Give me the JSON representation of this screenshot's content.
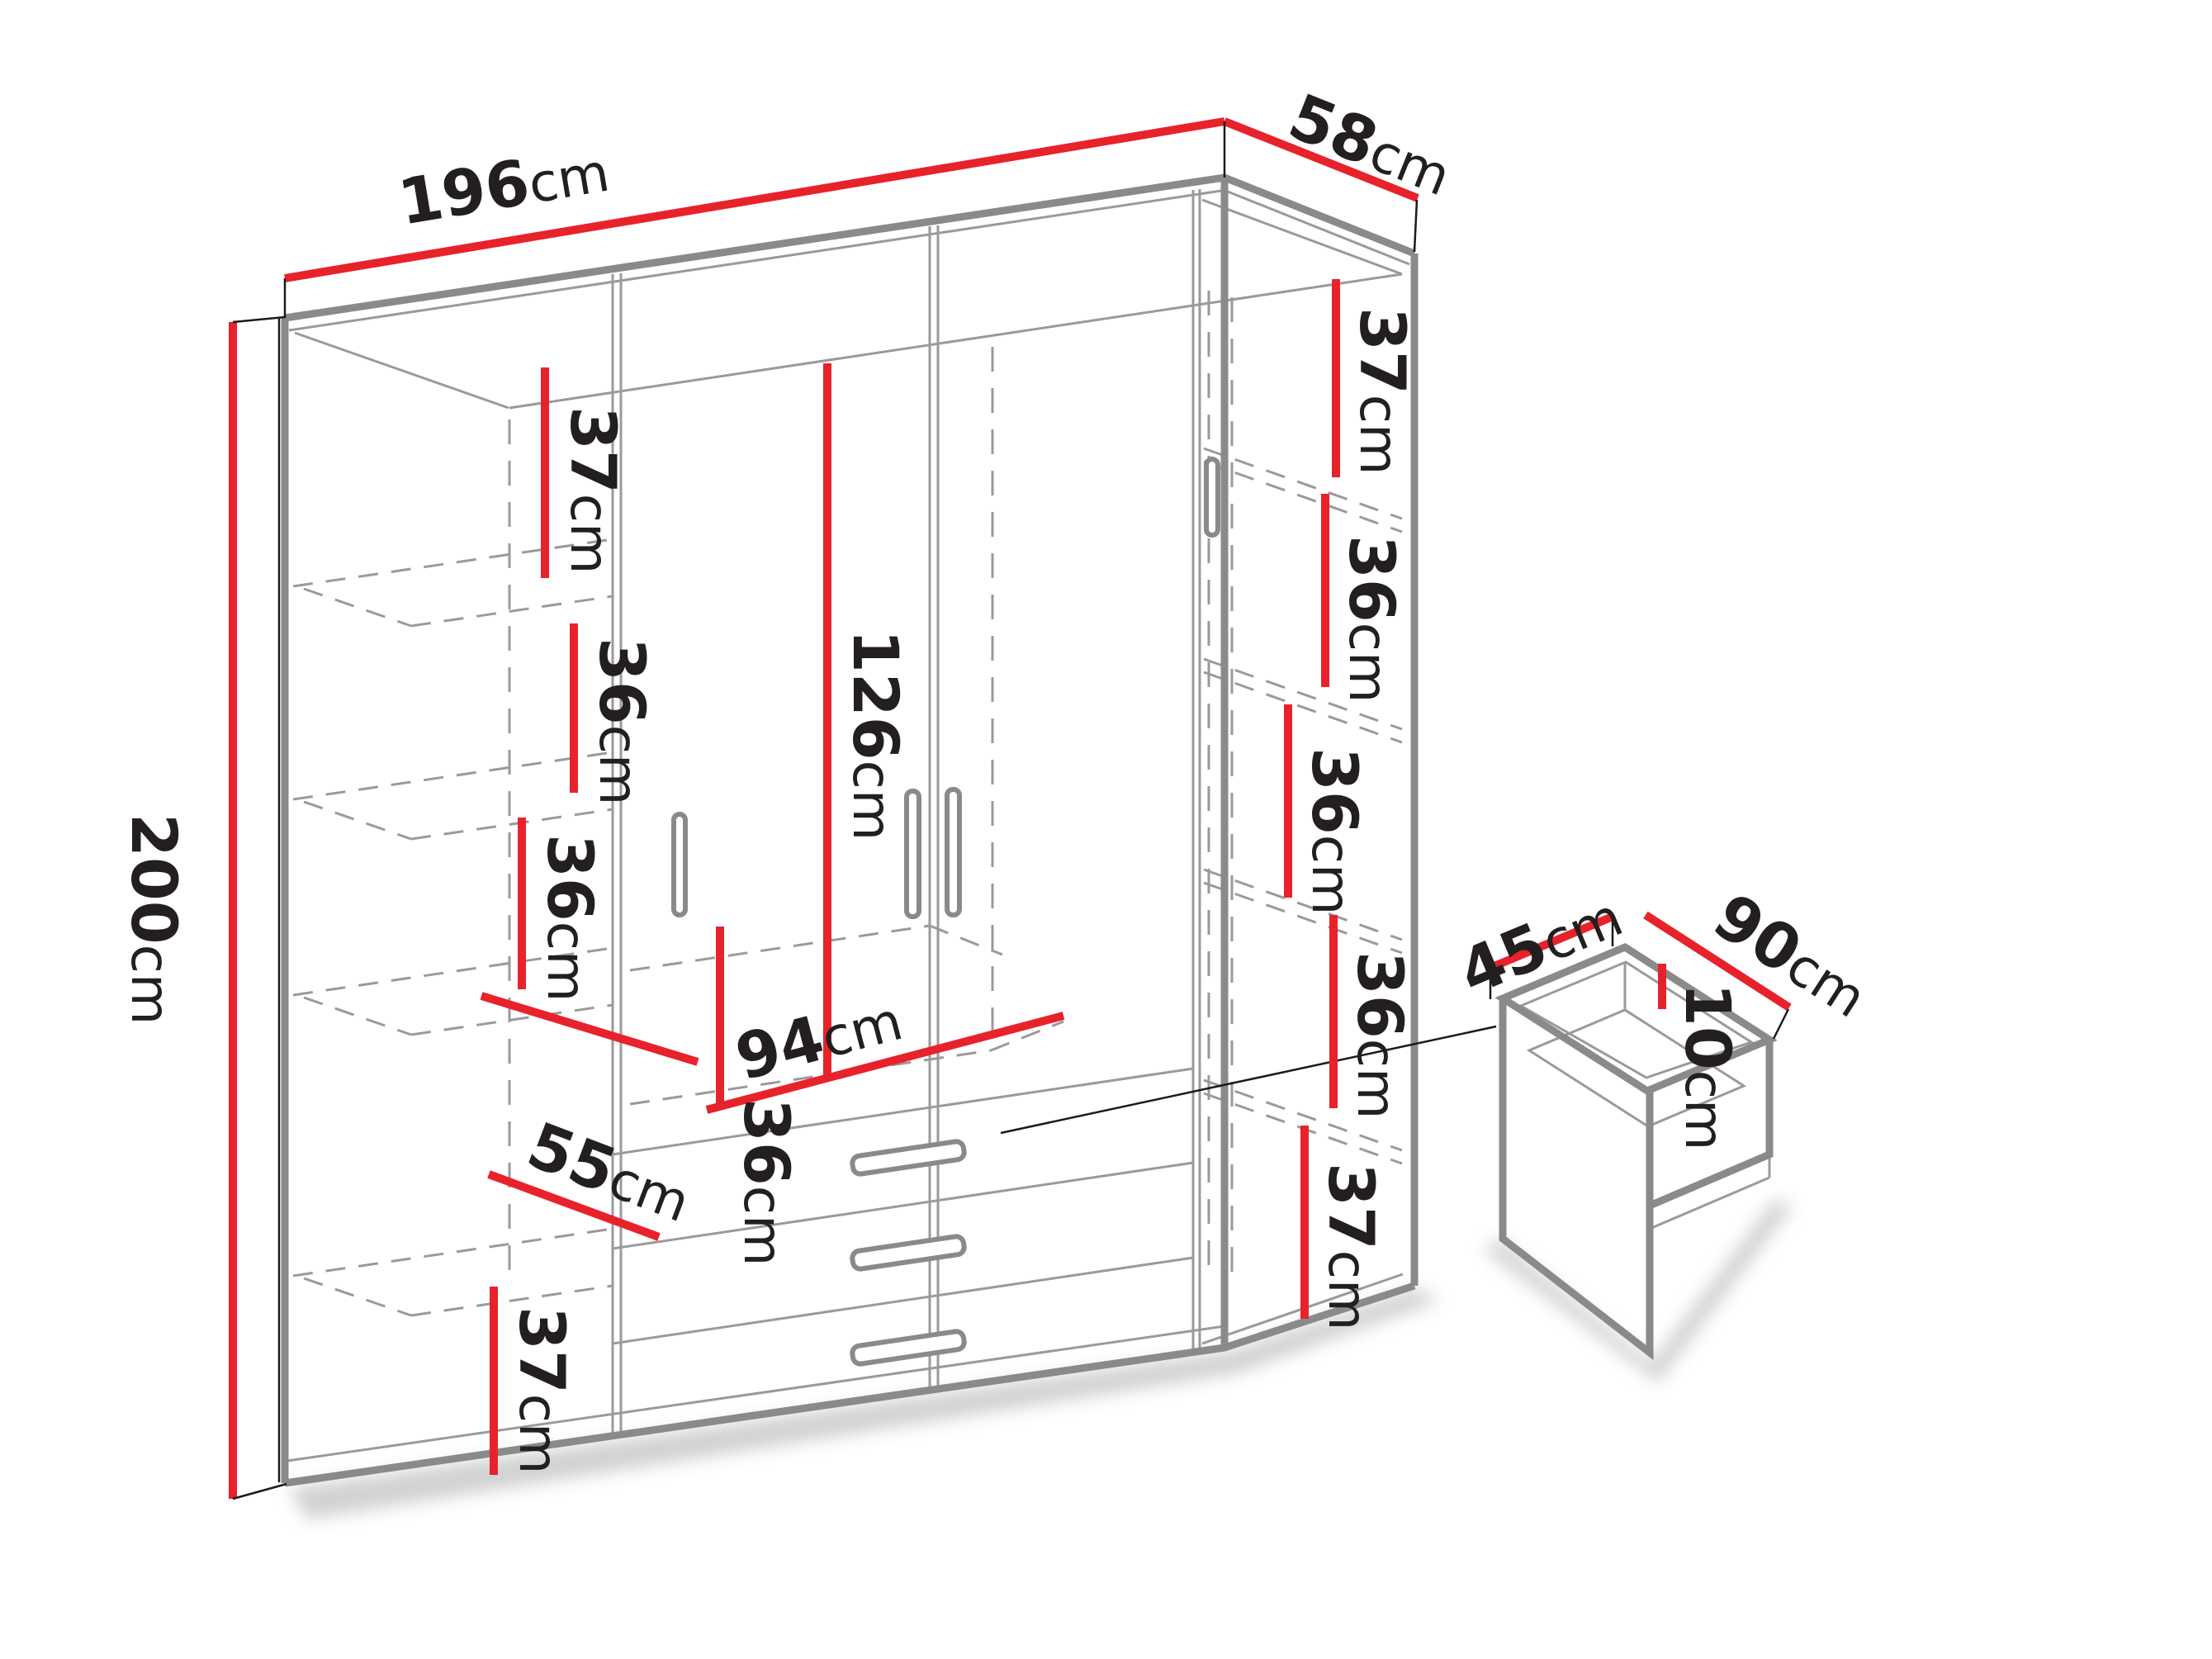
{
  "page": {
    "background": "#ffffff"
  },
  "colors": {
    "dimension_line": "#e8222b",
    "edge": "#8a8a8a",
    "hidden_line": "#9a9a9a",
    "leader": "#1a1a1a",
    "text": "#231f20"
  },
  "wardrobe": {
    "overall": {
      "width": {
        "num": "196",
        "unit": "cm"
      },
      "depth": {
        "num": "58",
        "unit": "cm"
      },
      "height": {
        "num": "200",
        "unit": "cm"
      }
    },
    "left_column": {
      "compartments": [
        {
          "num": "37",
          "unit": "cm"
        },
        {
          "num": "36",
          "unit": "cm"
        },
        {
          "num": "36",
          "unit": "cm"
        },
        {
          "num": "55",
          "unit": "cm"
        },
        {
          "num": "37",
          "unit": "cm"
        }
      ]
    },
    "middle_section": {
      "hanging_height": {
        "num": "126",
        "unit": "cm"
      },
      "shelf_above_drawers": {
        "num": "36",
        "unit": "cm"
      },
      "interior_width": {
        "num": "94",
        "unit": "cm"
      }
    },
    "right_column": {
      "compartments": [
        {
          "num": "37",
          "unit": "cm"
        },
        {
          "num": "36",
          "unit": "cm"
        },
        {
          "num": "36",
          "unit": "cm"
        },
        {
          "num": "36",
          "unit": "cm"
        },
        {
          "num": "37",
          "unit": "cm"
        }
      ]
    }
  },
  "drawer_detail": {
    "depth": {
      "num": "45",
      "unit": "cm"
    },
    "width": {
      "num": "90",
      "unit": "cm"
    },
    "height": {
      "num": "10",
      "unit": "cm"
    }
  }
}
